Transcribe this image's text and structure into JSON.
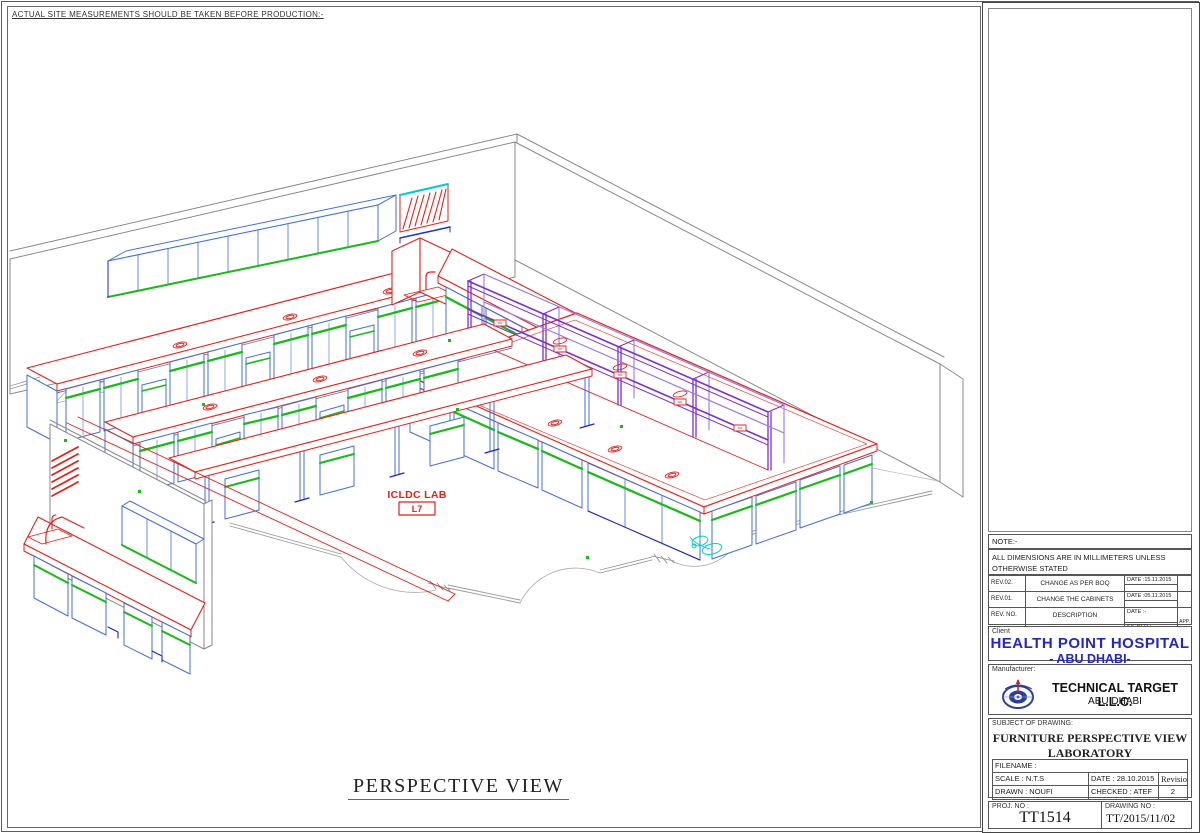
{
  "top_note": "ACTUAL SITE MEASUREMENTS SHOULD BE TAKEN BEFORE PRODUCTION:-",
  "drawing": {
    "caption": "PERSPECTIVE VIEW",
    "room_label": "ICLDC LAB",
    "room_number": "L7",
    "storage_label": "STORAGE",
    "colors": {
      "cad_red": "#e32119",
      "cad_green": "#19b919",
      "cad_blue": "#4070dd",
      "cad_dark_blue": "#2121cc",
      "cad_purple": "#7b2fd2",
      "cad_cyan": "#00cccc",
      "wall_gray": "#8a8a8a"
    }
  },
  "title_block": {
    "note_heading": "NOTE:-",
    "note_text": "ALL DIMENSIONS ARE IN MILLIMETERS UNLESS OTHERWISE STATED",
    "revisions": [
      {
        "rev": "REV.02.",
        "description": "CHANGE AS PER BOQ",
        "date": "DATE :15.11.2015",
        "signed": "",
        "app": ""
      },
      {
        "rev": "REV.01.",
        "description": "CHANGE THE CABINETS",
        "date": "DATE :05.11.2015",
        "signed": "",
        "app": ""
      },
      {
        "rev": "REV. NO.",
        "description": "DESCRIPTION",
        "date": "DATE :-",
        "signed": "SIGNED :-",
        "app": "APP."
      }
    ],
    "client": {
      "label": "Client",
      "name": "HEALTH POINT HOSPITAL",
      "city": "- ABU DHABI-",
      "accent": "#2525cd"
    },
    "manufacturer": {
      "label": "Manufacturer:",
      "name": "TECHNICAL TARGET L.L.C.",
      "city": "ABU DHABI"
    },
    "subject": {
      "label": "SUBJECT OF DRAWING:",
      "line1": "FURNITURE PERSPECTIVE VIEW",
      "line2": "LABORATORY"
    },
    "fields": {
      "filename": "FILENAME :",
      "scale": "SCALE : N.T.S",
      "date": "DATE : 28.10.2015",
      "revision_label": "Revision",
      "drawn": "DRAWN : NOUFI",
      "checked": "CHECKED : ATEF",
      "revision_value": "2",
      "proj_label": "PROJ. NO :",
      "proj_value": "TT1514",
      "drawing_no_label": "DRAWING NO :",
      "drawing_no_value": "TT/2015/11/02"
    }
  }
}
